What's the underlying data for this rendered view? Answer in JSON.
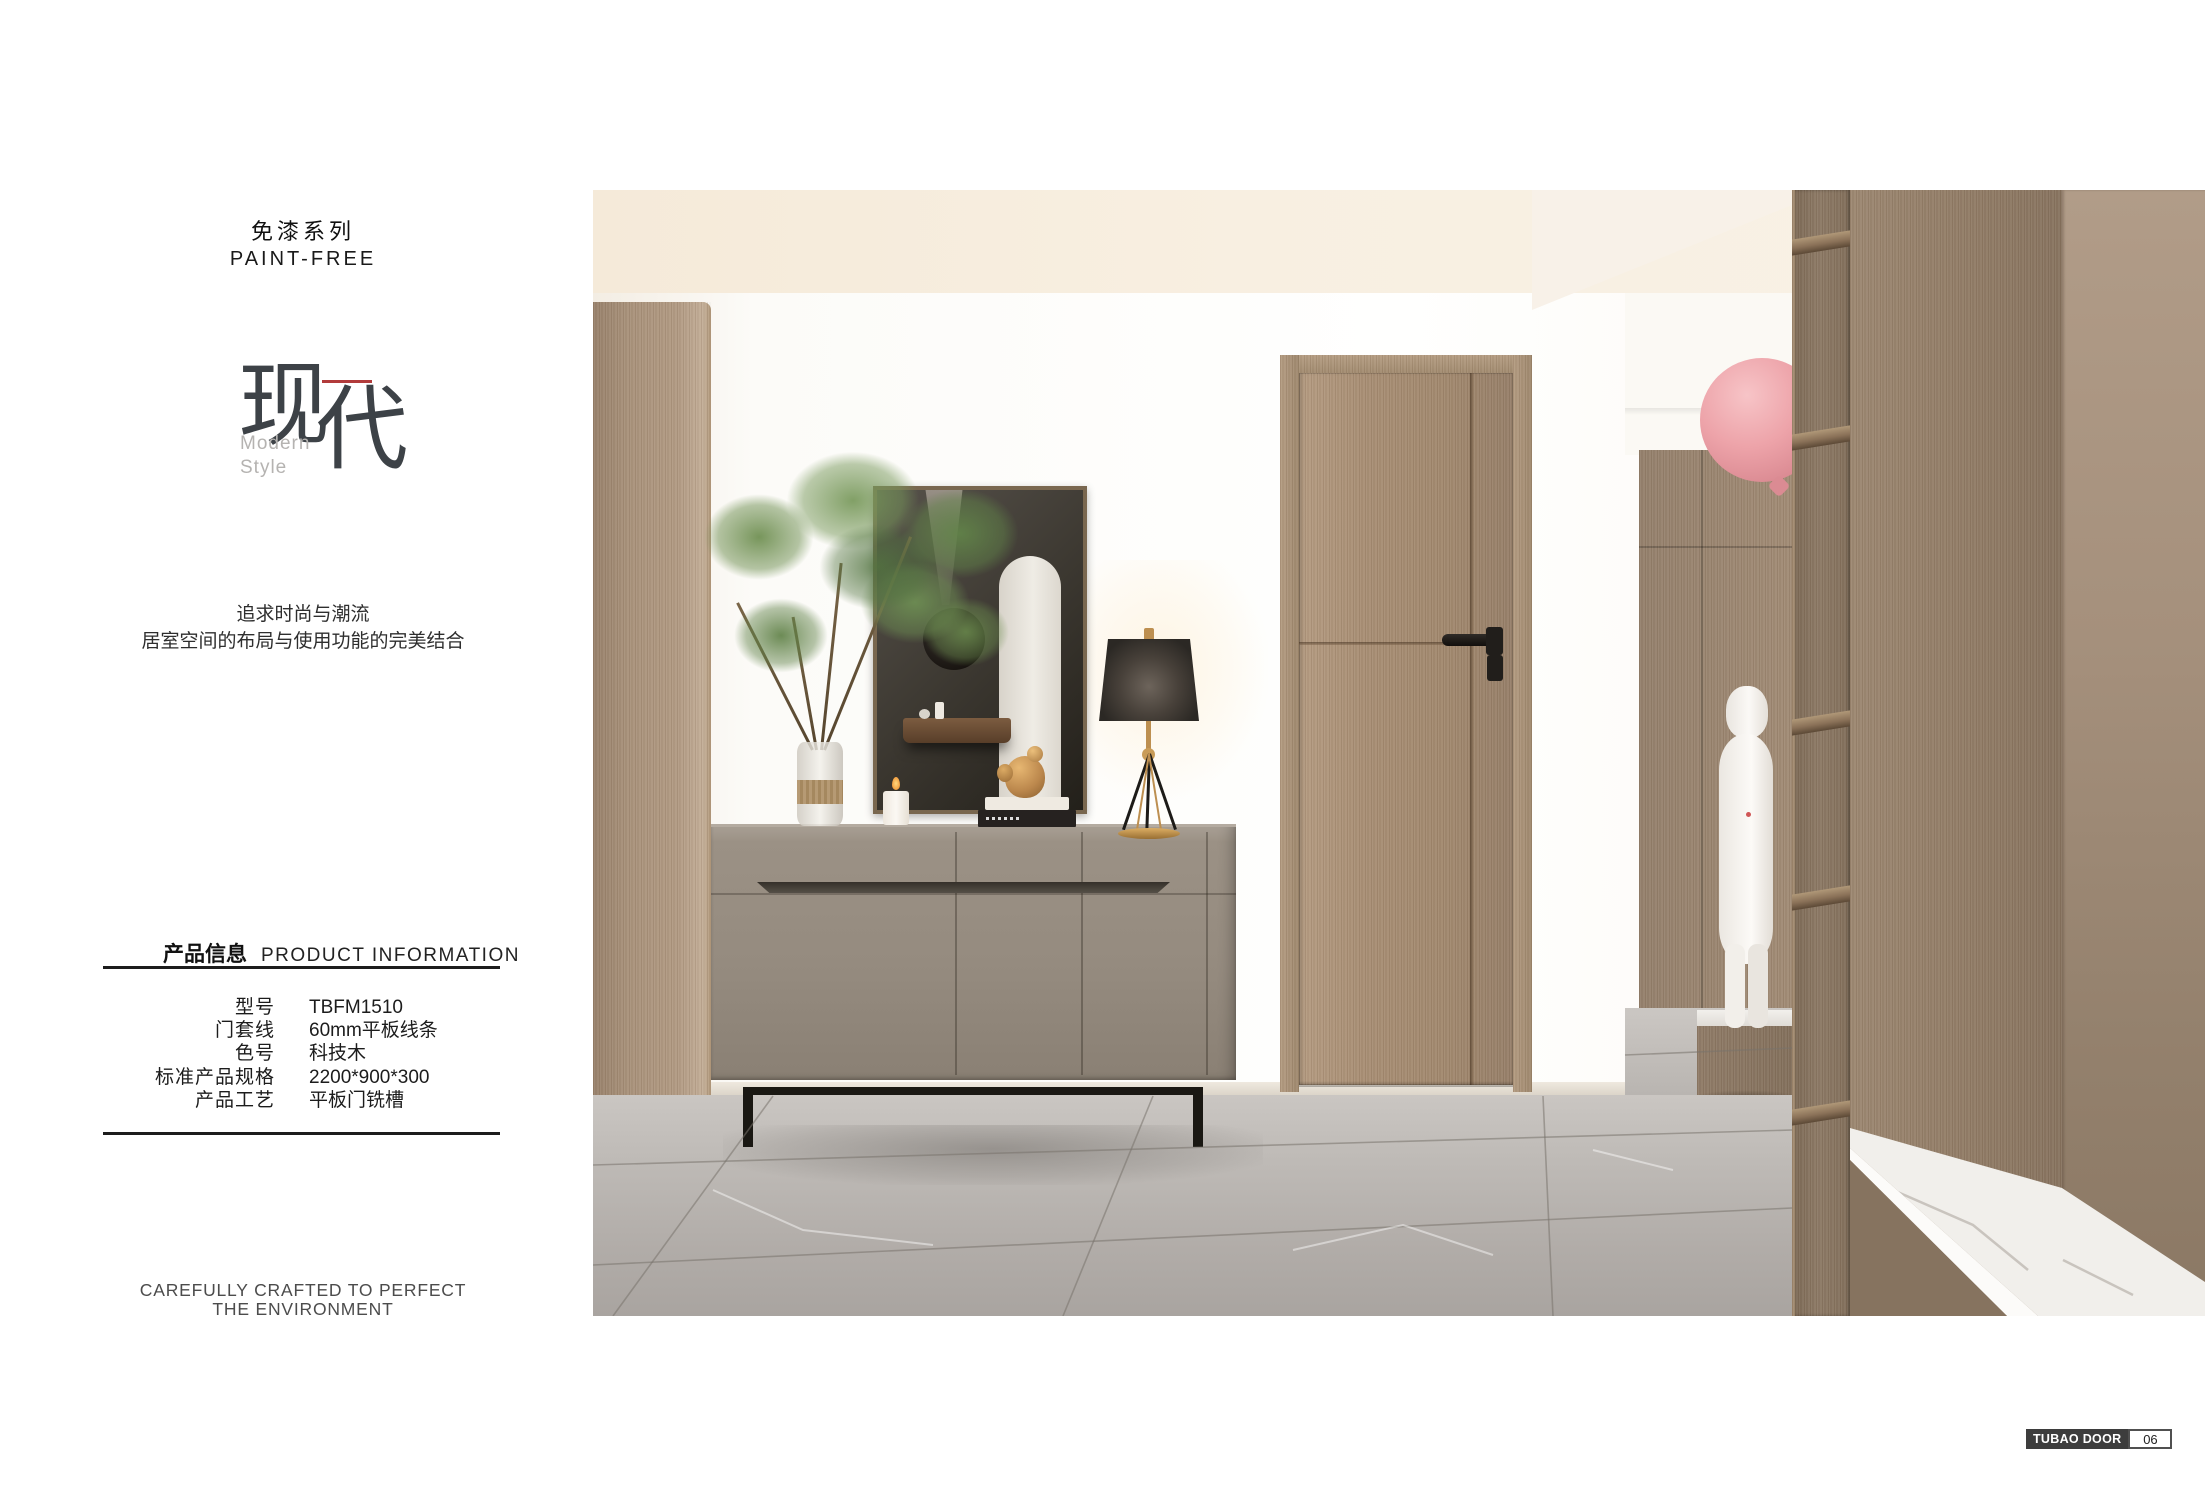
{
  "page": {
    "series_title_cn": "免漆系列",
    "series_title_en": "PAINT-FREE",
    "logo": {
      "char_1": "现",
      "char_2": "代",
      "subtitle_1": "Modern",
      "subtitle_2": "Style"
    },
    "tagline_1": "追求时尚与潮流",
    "tagline_2": "居室空间的布局与使用功能的完美结合",
    "footer_1": "CAREFULLY CRAFTED TO PERFECT",
    "footer_2": "THE ENVIRONMENT",
    "badge": {
      "brand": "TUBAO DOOR",
      "page_no": "06"
    }
  },
  "product_info": {
    "header_cn": "产品信息",
    "header_en": "PRODUCT  INFORMATION",
    "rows": [
      {
        "label": "型号",
        "value": "TBFM1510"
      },
      {
        "label": "门套线",
        "value": "60mm平板线条"
      },
      {
        "label": "色号",
        "value": "科技木"
      },
      {
        "label": "标准产品规格",
        "value": "2200*900*300"
      },
      {
        "label": "产品工艺",
        "value": "平板门铣槽"
      }
    ]
  },
  "colors": {
    "accent_red": "#b23b3b",
    "door_wood": "#a68e74",
    "sideboard_gray": "#95897d",
    "floor_marble": "#b3afab",
    "balloon_pink": "#ec9ba1",
    "brass_gold": "#bd8f50",
    "badge_dark": "#3d3d3d"
  }
}
